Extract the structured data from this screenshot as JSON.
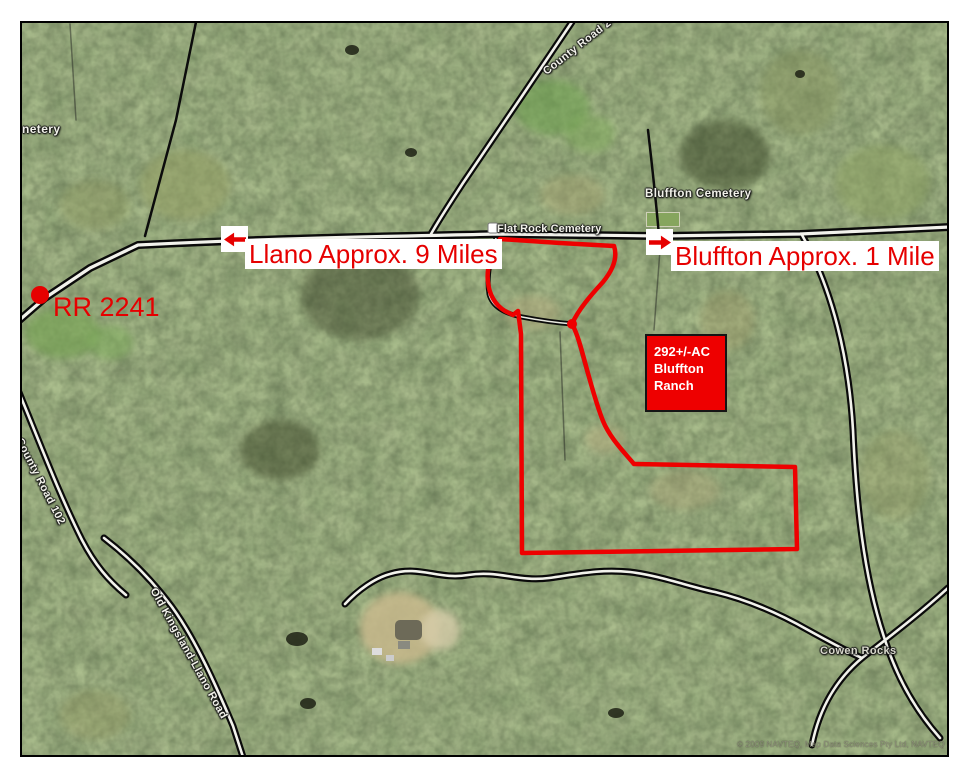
{
  "annotations": {
    "llano_label": "Llano Approx. 9 Miles",
    "bluffton_label": "Bluffton Approx. 1 Mile",
    "rr_label": "RR 2241",
    "ranch_box": {
      "line1": "292+/-AC",
      "line2": "Bluffton",
      "line3": "Ranch"
    },
    "accent_red": "#e60000",
    "boundary_red": "#ee0000"
  },
  "map_labels": {
    "county_road_247": "County Road 247",
    "bluffton_cemetery": "Bluffton Cemetery",
    "flat_rock_cemetery": "Flat Rock Cemetery",
    "county_road_102": "County Road 102",
    "old_kingsland_llano_road": "Old Kingsland-Llano Road",
    "cowen_rocks": "Cowen Rocks",
    "partial_cemetery": "netery",
    "copyright": "© 2009 NAVTEQ, Map Data Sciences Pty Ltd, NAVTEQ"
  }
}
